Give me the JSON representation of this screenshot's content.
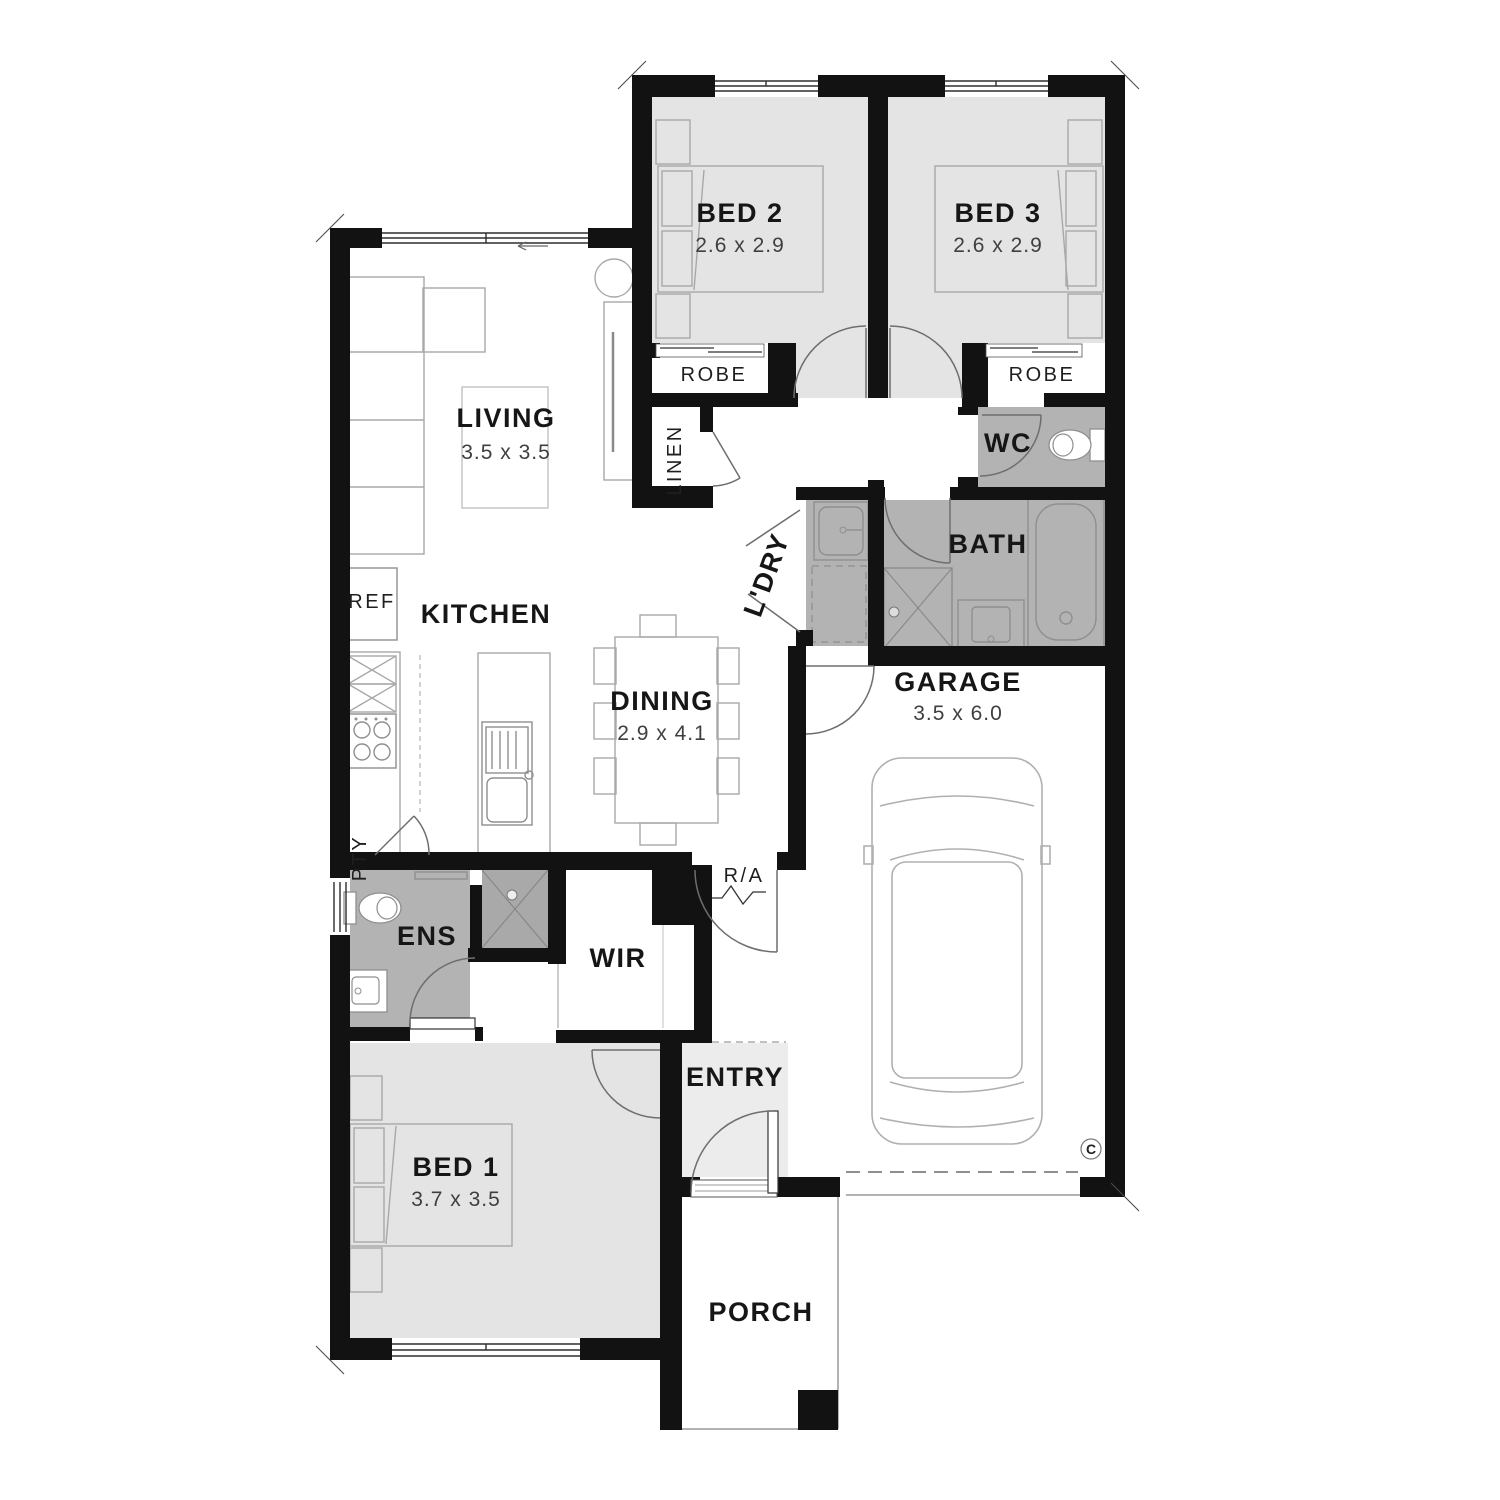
{
  "title": "Three bedroom single storey house floor plan",
  "colors": {
    "wall": "#121212",
    "room_fill": "#e4e4e4",
    "wet_area_fill": "#b3b3b3",
    "shower_fill": "#a9a9a9",
    "entry_fill": "#ececec",
    "furniture_stroke": "#a8a8a8",
    "label_text": "#161616",
    "dim_text": "#3f3f3f"
  },
  "rooms": {
    "bed2": {
      "label": "BED 2",
      "dims": "2.6 x 2.9"
    },
    "bed3": {
      "label": "BED 3",
      "dims": "2.6 x 2.9"
    },
    "living": {
      "label": "LIVING",
      "dims": "3.5 x 3.5"
    },
    "kitchen": {
      "label": "KITCHEN"
    },
    "dining": {
      "label": "DINING",
      "dims": "2.9 x 4.1"
    },
    "garage": {
      "label": "GARAGE",
      "dims": "3.5 x 6.0"
    },
    "bed1": {
      "label": "BED 1",
      "dims": "3.7 x 3.5"
    },
    "entry": {
      "label": "ENTRY"
    },
    "porch": {
      "label": "PORCH"
    },
    "wc": {
      "label": "WC"
    },
    "bath": {
      "label": "BATH"
    },
    "ens": {
      "label": "ENS"
    },
    "wir": {
      "label": "WIR"
    },
    "ldry": {
      "label": "L'DRY"
    },
    "linen": {
      "label": "LINEN"
    }
  },
  "labels": {
    "robe_left": "ROBE",
    "robe_right": "ROBE",
    "ref": "REF",
    "pty": "PTY",
    "ra": "R/A",
    "marker_c": "C"
  }
}
